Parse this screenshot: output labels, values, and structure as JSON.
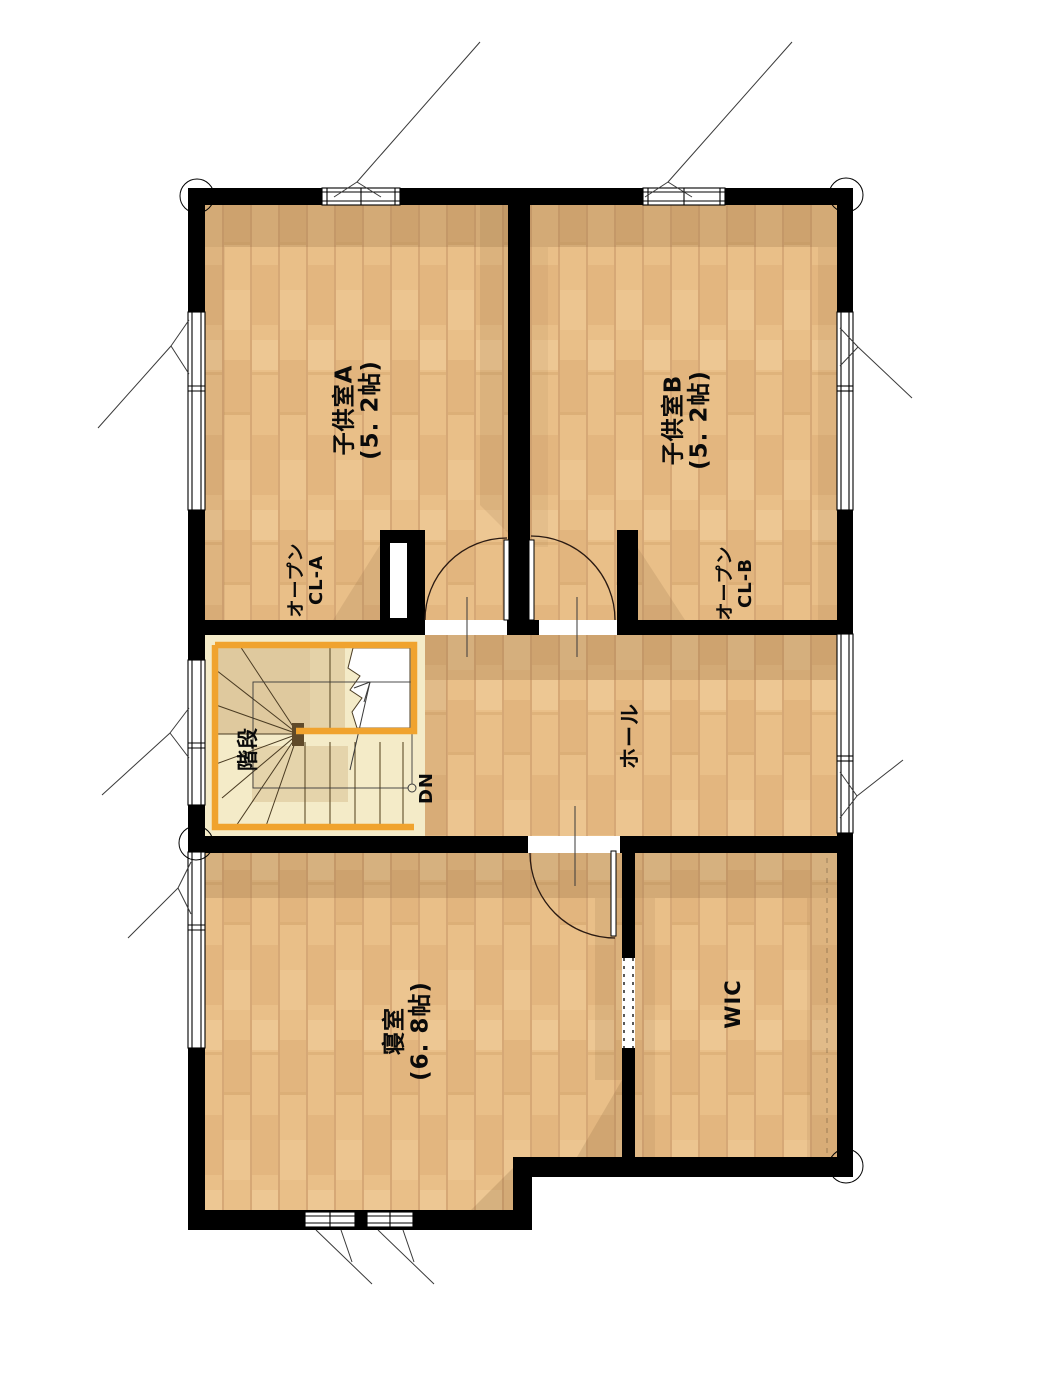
{
  "document": {
    "type": "floor-plan",
    "floor": "2F"
  },
  "rooms": [
    {
      "id": "kodomo-a",
      "name": "子供室A",
      "size": "(5. 2帖)"
    },
    {
      "id": "kodomo-b",
      "name": "子供室B",
      "size": "(5. 2帖)"
    },
    {
      "id": "shinshitsu",
      "name": "寝室",
      "size": "(6. 8帖)"
    },
    {
      "id": "hall",
      "name": "ホール"
    },
    {
      "id": "kaidan",
      "name": "階段"
    },
    {
      "id": "wic",
      "name": "WIC"
    }
  ],
  "closets": [
    {
      "id": "cl-a",
      "line1": "オープン",
      "line2": "CL-A"
    },
    {
      "id": "cl-b",
      "line1": "オープン",
      "line2": "CL-B"
    }
  ],
  "stairs": {
    "direction_label": "DN"
  },
  "colors": {
    "wall": "#000000",
    "floor_wood": "#e9bf88",
    "plank_line": "#d6a876",
    "stair_floor": "#f4ebc8",
    "stair_rail": "#f0a32e",
    "door_arc": "#2a1a12",
    "background": "#ffffff"
  }
}
